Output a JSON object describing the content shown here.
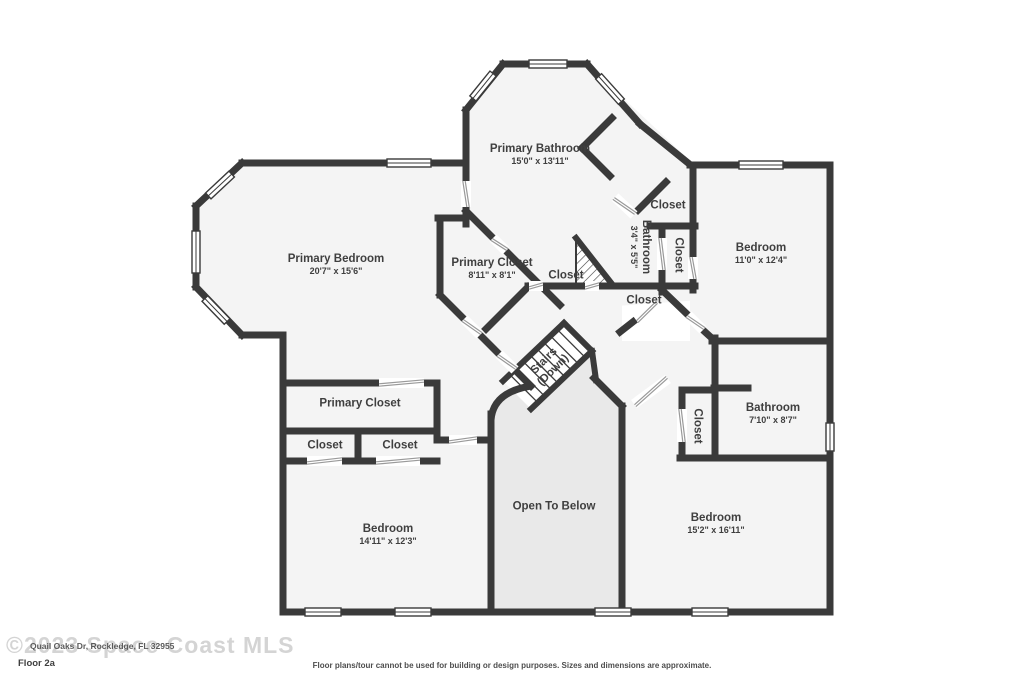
{
  "plan": {
    "colors": {
      "wall": "#3a3a3a",
      "room_fill": "#f4f4f4",
      "open_area_fill": "#e9e9e9",
      "label_text": "#3f3f3f",
      "door_line": "#9a9a9a"
    },
    "rooms": [
      {
        "id": "primary-bathroom",
        "name": "Primary Bathroom",
        "dims": "15'0\" x 13'11\""
      },
      {
        "id": "primary-bedroom",
        "name": "Primary Bedroom",
        "dims": "20'7\" x 15'6\""
      },
      {
        "id": "primary-closet-upper",
        "name": "Primary Closet",
        "dims": "8'11\" x 8'1\""
      },
      {
        "id": "closet-central",
        "name": "Closet",
        "dims": ""
      },
      {
        "id": "closet-top-right",
        "name": "Closet",
        "dims": ""
      },
      {
        "id": "bathroom-small",
        "name": "Bathroom",
        "dims": "3'4\" x 5'5\""
      },
      {
        "id": "closet-vertical-top",
        "name": "Closet",
        "dims": ""
      },
      {
        "id": "bedroom-ne",
        "name": "Bedroom",
        "dims": "11'0\" x 12'4\""
      },
      {
        "id": "closet-mid-right",
        "name": "Closet",
        "dims": ""
      },
      {
        "id": "stairs",
        "name": "Stairs",
        "dims": "(Down)"
      },
      {
        "id": "primary-closet-lower",
        "name": "Primary Closet",
        "dims": ""
      },
      {
        "id": "closet-left-a",
        "name": "Closet",
        "dims": ""
      },
      {
        "id": "closet-left-b",
        "name": "Closet",
        "dims": ""
      },
      {
        "id": "bedroom-sw",
        "name": "Bedroom",
        "dims": "14'11\" x 12'3\""
      },
      {
        "id": "open-to-below",
        "name": "Open To Below",
        "dims": ""
      },
      {
        "id": "closet-vertical-bottom",
        "name": "Closet",
        "dims": ""
      },
      {
        "id": "bathroom-right",
        "name": "Bathroom",
        "dims": "7'10\" x 8'7\""
      },
      {
        "id": "bedroom-se",
        "name": "Bedroom",
        "dims": "15'2\" x 16'11\""
      }
    ]
  },
  "footer": {
    "watermark": "©2023 Space Coast MLS",
    "address": "Quail Oaks Dr, Rockledge, FL 32955",
    "floor_label": "Floor 2a",
    "disclaimer": "Floor plans/tour cannot be used for building or design purposes. Sizes and dimensions are approximate."
  }
}
